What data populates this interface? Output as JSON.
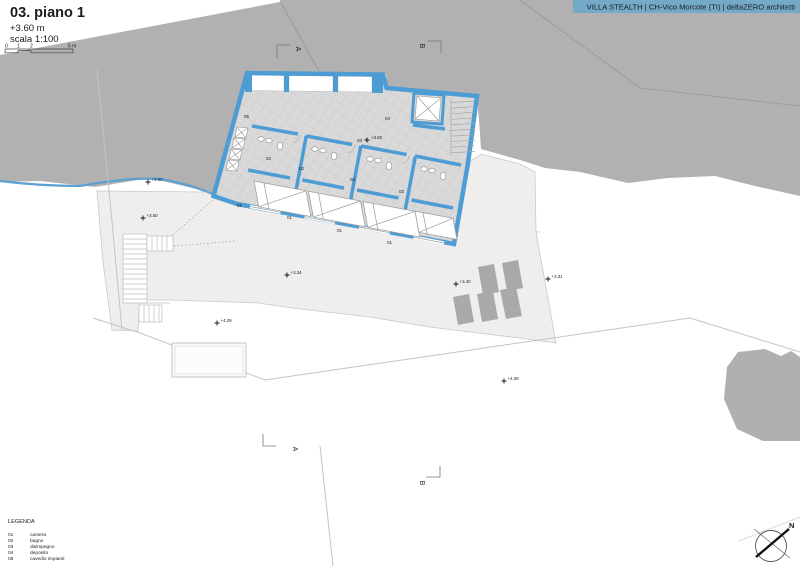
{
  "header": {
    "project_label": "VILLA STEALTH | CH-Vico Morcote (TI) | deltaZERO architetti"
  },
  "title_block": {
    "title": "03. piano 1",
    "level": "+3.60 m",
    "scale": "scala 1:100",
    "scale_bar": {
      "t0": "0",
      "t1": "1",
      "t2": "2",
      "t5": "5 m"
    }
  },
  "legend": {
    "heading": "LEGENDA",
    "items": [
      {
        "code": "01",
        "label": "camera"
      },
      {
        "code": "02",
        "label": "bagno"
      },
      {
        "code": "03",
        "label": "disimpegno"
      },
      {
        "code": "04",
        "label": "deposito"
      },
      {
        "code": "05",
        "label": "cavedio impianti"
      }
    ]
  },
  "plan": {
    "room_codes": {
      "camera": "01",
      "bagno": "02",
      "disimpegno": "03",
      "deposito": "04",
      "cavedio": "05"
    },
    "interior_level": "+3.60",
    "elevation_markers": [
      "+3.50",
      "+3.50",
      "+3.34",
      "+3.40",
      "+3.31",
      "+4.29",
      "+4.29"
    ],
    "section_markers": {
      "a": "A",
      "b": "B"
    },
    "north_label": "N"
  },
  "colors": {
    "wall_blue": "#4d9cd3",
    "banner_blue": "#74a9c7",
    "terrain_gray": "#b1b1b1",
    "terrace_gray": "#efeeec",
    "panel_gray": "#a9a9a9"
  }
}
